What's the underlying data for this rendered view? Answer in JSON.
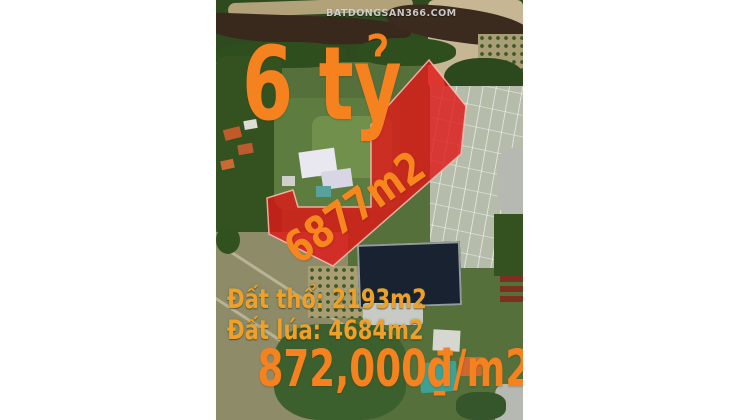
{
  "watermark": "BATDONGSAN366.COM",
  "listing": {
    "price_total": "6 tỷ",
    "area_total": "6877m2",
    "land_residential": "Đất thổ: 2193m2",
    "land_paddy": "Đất lúa: 4684m2",
    "price_per_m2": "872,000₫/m2"
  },
  "map": {
    "type": "satellite",
    "parcel_polygon_points": "213,60 250,106 245,154 117,266 53,234 51,198 77,190 82,207 155,207 155,125"
  },
  "colors": {
    "annotation_orange": "#f6821f",
    "annotation_amber": "#f0a028",
    "parcel_red": "#e11717",
    "background_white": "#ffffff"
  }
}
